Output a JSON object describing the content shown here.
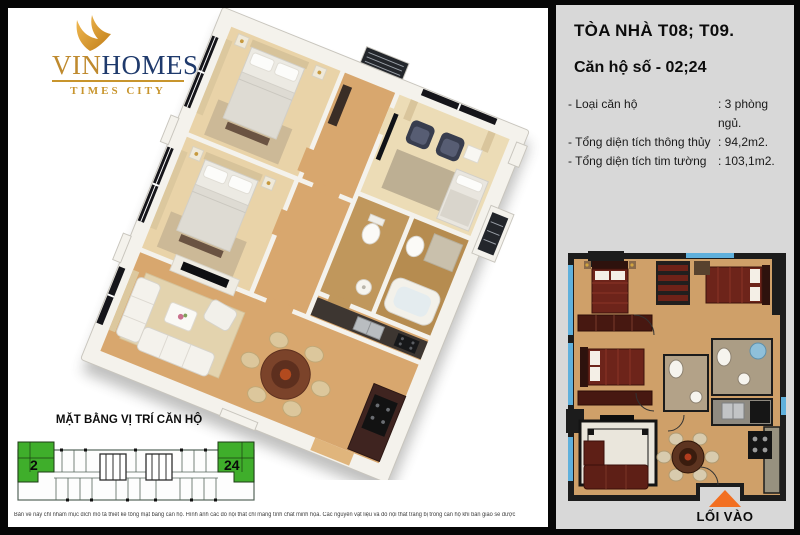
{
  "logo": {
    "vin": "VIN",
    "homes": "HOMES",
    "subtitle": "TIMES CITY"
  },
  "info": {
    "title": "TÒA NHÀ T08; T09.",
    "unit": "Căn hộ số - 02;24",
    "rows": [
      {
        "label": "- Loại căn hộ",
        "value": ": 3 phòng ngủ."
      },
      {
        "label": "- Tổng diện tích thông thủy",
        "value": ": 94,2m2."
      },
      {
        "label": "- Tổng diện tích tim tường",
        "value": ": 103,1m2."
      }
    ],
    "entrance_label": "LỐI VÀO"
  },
  "location": {
    "title": "MẶT BẰNG VỊ TRÍ CĂN HỘ",
    "unit_left": "2",
    "unit_right": "24"
  },
  "disclaimer": "Bản vẽ này chỉ nhằm mục đích mô tả thiết kế tổng mặt bằng căn hộ. Hình ảnh các đồ nội thất chỉ mang tính chất minh họa.  Các nguyên vật liệu và đồ nội thất trang bị trong căn hộ khi bàn giao sẽ được quy định cụ thể trong hợp đồng mua bán căn hộ.",
  "colors": {
    "logo_gold": "#c8952d",
    "logo_navy": "#1f3a6c",
    "highlight_green": "#3fae2b",
    "entrance_orange": "#f26f21",
    "panel_gray": "#d8d8d8"
  }
}
